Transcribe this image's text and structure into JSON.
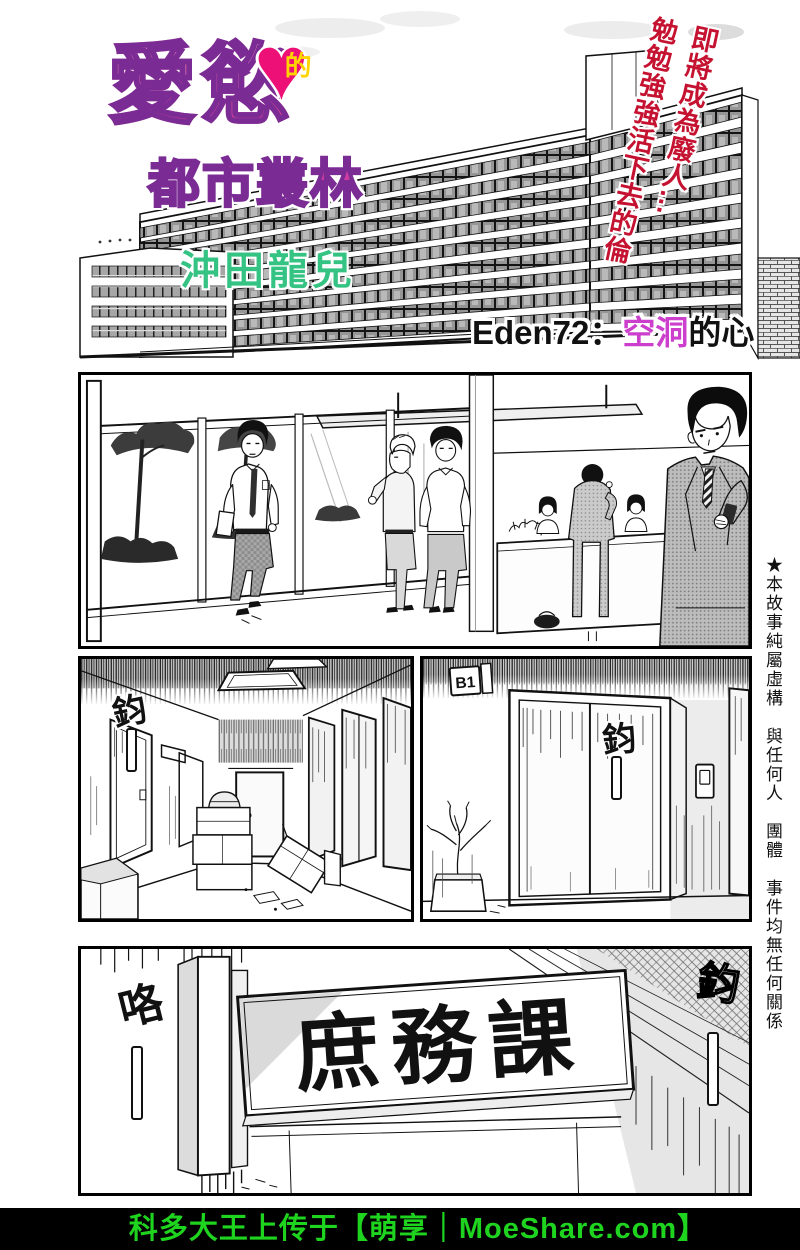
{
  "header": {
    "series_title": "愛慾",
    "heart_particle": "的",
    "series_subtitle": "都市叢林",
    "author": "沖田龍兒",
    "tagline": "即將成為廢人…\n勉勉強強活下去的倫",
    "episode_prefix": "Eden72：",
    "episode_highlight": "空洞",
    "episode_suffix": "的心"
  },
  "margin_note": "★本故事純屬虛構　與任何人　團體　事件均無任何關係",
  "panels": {
    "corridor_sfx": "鈞",
    "elevator_sfx": "鈞",
    "elevator_floor_sign": "B1",
    "door_sfx_left": "咯",
    "door_sfx_right": "鈞",
    "door_sign": "庶務課"
  },
  "footer": {
    "watermark": "科多大王上传于【萌享｜MoeShare.com】"
  },
  "colors": {
    "title_pink": "#d43f9b",
    "title_outline_purple": "#7b2c94",
    "heart_pink": "#ec1077",
    "heart_text_yellow": "#ffd400",
    "author_green": "#35c383",
    "tagline_red": "#c41230",
    "episode_highlight_magenta": "#cc3fcc",
    "watermark_green": "#1fd41f",
    "footer_bg": "#000000"
  }
}
